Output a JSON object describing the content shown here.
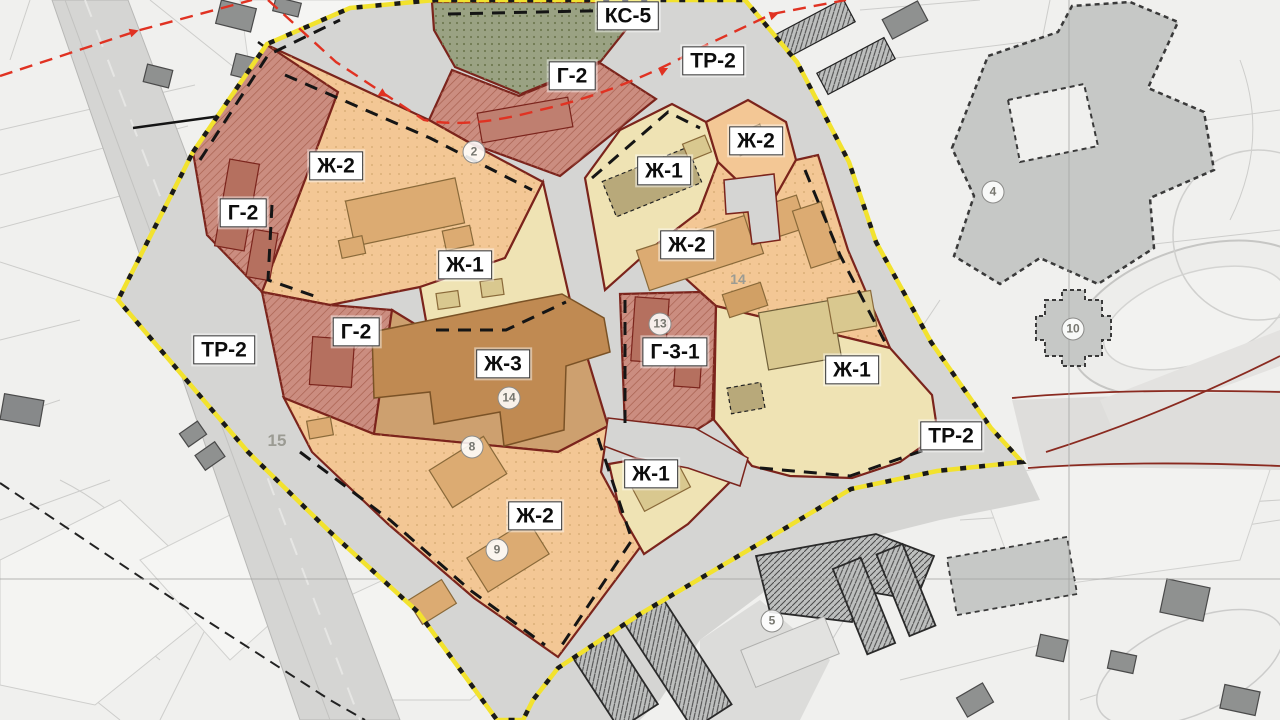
{
  "map": {
    "zone_labels": [
      {
        "text": "КС-5",
        "zone": "utility"
      },
      {
        "text": "ТР-2",
        "zone": "transport"
      },
      {
        "text": "Г-2",
        "zone": "public"
      },
      {
        "text": "Ж-2",
        "zone": "residential-mid"
      },
      {
        "text": "Ж-1",
        "zone": "residential-low"
      },
      {
        "text": "Ж-2",
        "zone": "residential-mid"
      },
      {
        "text": "Г-2",
        "zone": "public"
      },
      {
        "text": "Ж-2",
        "zone": "residential-mid"
      },
      {
        "text": "Ж-1",
        "zone": "residential-low"
      },
      {
        "text": "Г-2",
        "zone": "public"
      },
      {
        "text": "Ж-3",
        "zone": "residential-high"
      },
      {
        "text": "Г-3-1",
        "zone": "public"
      },
      {
        "text": "Ж-1",
        "zone": "residential-low"
      },
      {
        "text": "ТР-2",
        "zone": "transport"
      },
      {
        "text": "ТР-2",
        "zone": "transport"
      },
      {
        "text": "Ж-1",
        "zone": "residential-low"
      },
      {
        "text": "Ж-2",
        "zone": "residential-mid"
      }
    ],
    "markers": [
      "2",
      "4",
      "5",
      "8",
      "9",
      "10",
      "13",
      "14"
    ],
    "ground_numbers": [
      "14",
      "15"
    ],
    "colors": {
      "background": "#f0f0ee",
      "road": "#d5d5d3",
      "zone_zh1": "#efe3b4",
      "zone_zh2": "#f3c795",
      "zone_zh3": "#cda06f",
      "zone_g": "#cb8d80",
      "zone_ks": "#9aa283",
      "building_zh1": "#d9c88f",
      "building_zh2": "#dcab72",
      "building_zh3": "#c08a52",
      "building_g": "#b5705f",
      "building_olive": "#b8a97a",
      "zone_border": "#7b241c",
      "plan_boundary_yellow": "#f2e22e",
      "red_line": "#e03222",
      "existing_building": "#8f9190",
      "school_gray": "#c6c8c6"
    }
  }
}
